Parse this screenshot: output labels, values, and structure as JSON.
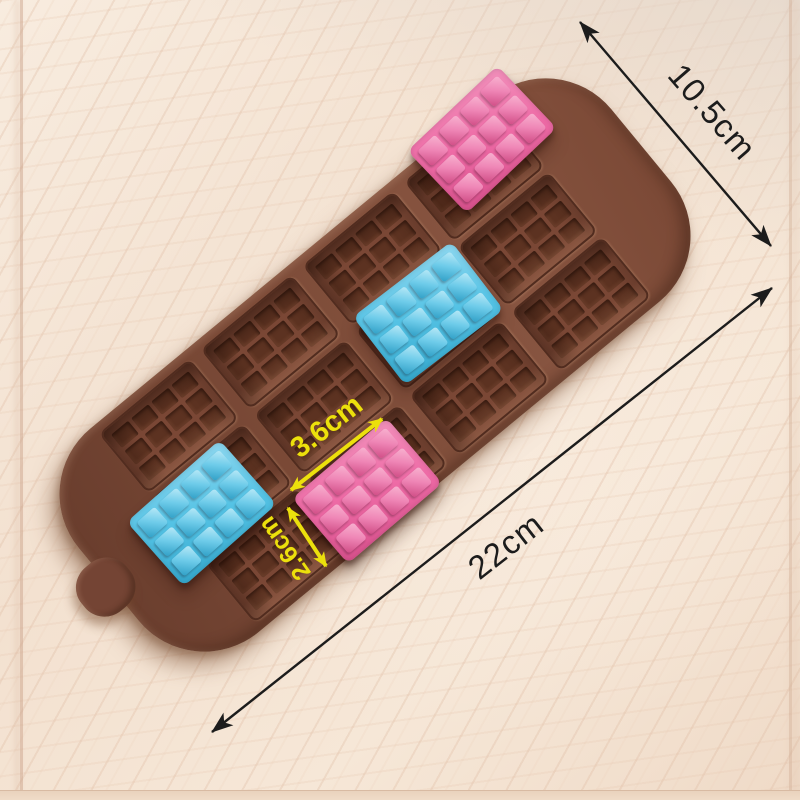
{
  "dimensions": {
    "mold_width_label": "10.5cm",
    "mold_length_label": "22cm",
    "bar_length_label": "3.6cm",
    "bar_width_label": "2.6cm"
  },
  "mold": {
    "cavity_rows": 3,
    "cavity_cols": 4,
    "cavity_fill": [
      [
        "empty",
        "empty",
        "empty",
        "pink"
      ],
      [
        "blue",
        "empty",
        "blue",
        "empty"
      ],
      [
        "empty",
        "pink",
        "empty",
        "empty"
      ]
    ],
    "bar_segment_rows": 3,
    "bar_segment_cols": 4,
    "colors": {
      "wood_background": "#f4e4d3",
      "mold_brown": "#7b4a37",
      "cavity_dark": "#5c3221",
      "bar_pink": "#ee6ba6",
      "bar_blue": "#55c3e5",
      "annotation_yellow": "#ece00c",
      "annotation_black": "#1c1c1c"
    }
  }
}
